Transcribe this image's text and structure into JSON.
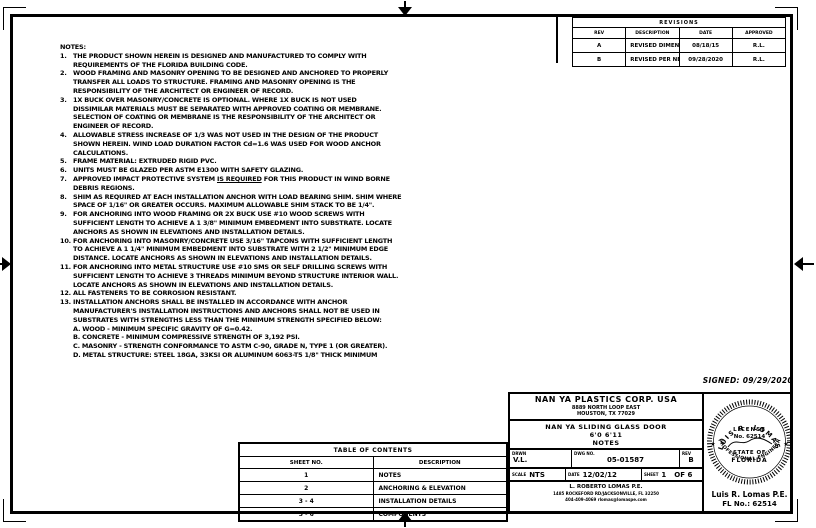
{
  "revisions": {
    "title": "REVISIONS",
    "headers": [
      "REV",
      "DESCRIPTION",
      "DATE",
      "APPROVED"
    ],
    "rows": [
      {
        "rev": "A",
        "description": "REVISED DIMENSIONS",
        "date": "08/18/15",
        "approved": "R.L."
      },
      {
        "rev": "B",
        "description": "REVISED PER NEW REQUIREMENTS",
        "date": "09/28/2020",
        "approved": "R.L."
      }
    ]
  },
  "notes": {
    "title": "NOTES:",
    "items": [
      {
        "num": "1.",
        "text": "THE PRODUCT SHOWN HEREIN IS DESIGNED AND MANUFACTURED TO COMPLY WITH\nREQUIREMENTS OF THE FLORIDA BUILDING CODE."
      },
      {
        "num": "2.",
        "text": "WOOD FRAMING AND MASONRY OPENING TO BE DESIGNED AND ANCHORED TO PROPERLY\nTRANSFER ALL LOADS TO STRUCTURE. FRAMING AND MASONRY OPENING IS THE\nRESPONSIBILITY OF THE ARCHITECT OR ENGINEER OF RECORD."
      },
      {
        "num": "3.",
        "text": "1X BUCK OVER MASONRY/CONCRETE IS OPTIONAL. WHERE 1X BUCK IS NOT USED\nDISSIMILAR MATERIALS MUST BE SEPARATED WITH APPROVED COATING OR MEMBRANE.\nSELECTION OF COATING OR MEMBRANE IS THE RESPONSIBILITY OF THE ARCHITECT OR\nENGINEER OF RECORD."
      },
      {
        "num": "4.",
        "text": "ALLOWABLE STRESS INCREASE OF 1/3 WAS NOT USED IN THE DESIGN OF THE PRODUCT\nSHOWN HEREIN. WIND LOAD DURATION FACTOR Cd=1.6 WAS USED FOR WOOD ANCHOR\nCALCULATIONS."
      },
      {
        "num": "5.",
        "text": "FRAME MATERIAL: EXTRUDED RIGID PVC."
      },
      {
        "num": "6.",
        "text": "UNITS MUST BE GLAZED PER ASTM E1300 WITH SAFETY GLAZING."
      },
      {
        "num": "7.",
        "parts": [
          {
            "text": "APPROVED IMPACT PROTECTIVE SYSTEM "
          },
          {
            "text": "IS REQUIRED",
            "u": true
          },
          {
            "text": " FOR THIS PRODUCT IN WIND BORNE\nDEBRIS REGIONS."
          }
        ]
      },
      {
        "num": "8.",
        "text": "SHIM AS REQUIRED AT EACH INSTALLATION ANCHOR WITH LOAD BEARING SHIM. SHIM WHERE\nSPACE OF 1/16\" OR GREATER OCCURS. MAXIMUM ALLOWABLE SHIM STACK TO BE 1/4\"."
      },
      {
        "num": "9.",
        "text": "FOR ANCHORING INTO WOOD FRAMING OR 2X BUCK USE #10 WOOD SCREWS WITH\nSUFFICIENT LENGTH TO ACHIEVE A 1 3/8\" MINIMUM EMBEDMENT INTO SUBSTRATE. LOCATE\nANCHORS AS SHOWN IN ELEVATIONS AND INSTALLATION DETAILS."
      },
      {
        "num": "10.",
        "text": "FOR ANCHORING INTO MASONRY/CONCRETE USE 3/16\" TAPCONS WITH SUFFICIENT LENGTH\nTO ACHIEVE A 1 1/4\" MINIMUM EMBEDMENT INTO SUBSTRATE WITH 2 1/2\" MINIMUM EDGE\nDISTANCE. LOCATE ANCHORS AS SHOWN IN ELEVATIONS AND INSTALLATION DETAILS."
      },
      {
        "num": "11.",
        "text": "FOR ANCHORING INTO METAL STRUCTURE USE #10 SMS OR SELF DRILLING SCREWS WITH\nSUFFICIENT LENGTH TO ACHIEVE 3 THREADS MINIMUM BEYOND STRUCTURE INTERIOR WALL.\nLOCATE ANCHORS AS SHOWN IN ELEVATIONS AND INSTALLATION DETAILS."
      },
      {
        "num": "12.",
        "text": "ALL FASTENERS TO BE CORROSION RESISTANT."
      },
      {
        "num": "13.",
        "text": "INSTALLATION ANCHORS SHALL BE INSTALLED IN ACCORDANCE WITH ANCHOR\nMANUFACTURER'S INSTALLATION INSTRUCTIONS AND ANCHORS SHALL NOT BE USED IN\nSUBSTRATES WITH STRENGTHS LESS THAN THE MINIMUM STRENGTH SPECIFIED BELOW:\nA. WOOD - MINIMUM SPECIFIC GRAVITY OF G=0.42.\nB. CONCRETE - MINIMUM COMPRESSIVE STRENGTH OF 3,192 PSI.\nC. MASONRY - STRENGTH CONFORMANCE TO ASTM C-90, GRADE N, TYPE 1 (OR GREATER).\nD. METAL STRUCTURE: STEEL 18GA, 33KSI OR ALUMINUM 6063-T5 1/8\" THICK MINIMUM"
      }
    ]
  },
  "toc": {
    "title": "TABLE OF CONTENTS",
    "headers": [
      "SHEET NO.",
      "DESCRIPTION"
    ],
    "rows": [
      [
        "1",
        "NOTES"
      ],
      [
        "2",
        "ANCHORING & ELEVATION"
      ],
      [
        "3 - 4",
        "INSTALLATION DETAILS"
      ],
      [
        "5 - 6",
        "COMPONENTS"
      ]
    ]
  },
  "title_block": {
    "company_name": "NAN YA PLASTICS CORP. USA",
    "address_line1": "8889 NORTH LOOP EAST",
    "address_line2": "HOUSTON, TX 77029",
    "product_line1": "NAN YA SLIDING GLASS DOOR",
    "product_line2": "6'0 6'11",
    "product_line3": "NOTES",
    "drwn_label": "DRWN",
    "drwn_value": "V.L.",
    "dwg_no_label": "DWG NO.",
    "dwg_no_value": "05-01587",
    "rev_label": "REV",
    "rev_value": "B",
    "scale_label": "SCALE",
    "scale_value": "NTS",
    "date_label": "DATE",
    "date_value": "12/02/12",
    "sheet_label": "SHEET",
    "sheet_value": "1",
    "sheet_of": "OF 6",
    "engineer_line1": "L. ROBERTO LOMAS P.E.",
    "engineer_line2": "1485 ROCKEFORD RD/JACKSONVILLE, FL 32250",
    "engineer_line3": "404-409-4069    rlomas@lomaspe.com"
  },
  "signed_note": "SIGNED: 09/29/2020",
  "seal": {
    "arc_top": "LUIS R. LOMAS",
    "license": "LICENSE",
    "number": "No. 62514",
    "state_of": "STATE OF",
    "state": "FLORIDA",
    "arc_bottom": "PROFESSIONAL ENGINEER",
    "star_left": "★",
    "star_right": "★",
    "name_line": "Luis R. Lomas P.E.",
    "fl_line": "FL No.: 62514"
  }
}
